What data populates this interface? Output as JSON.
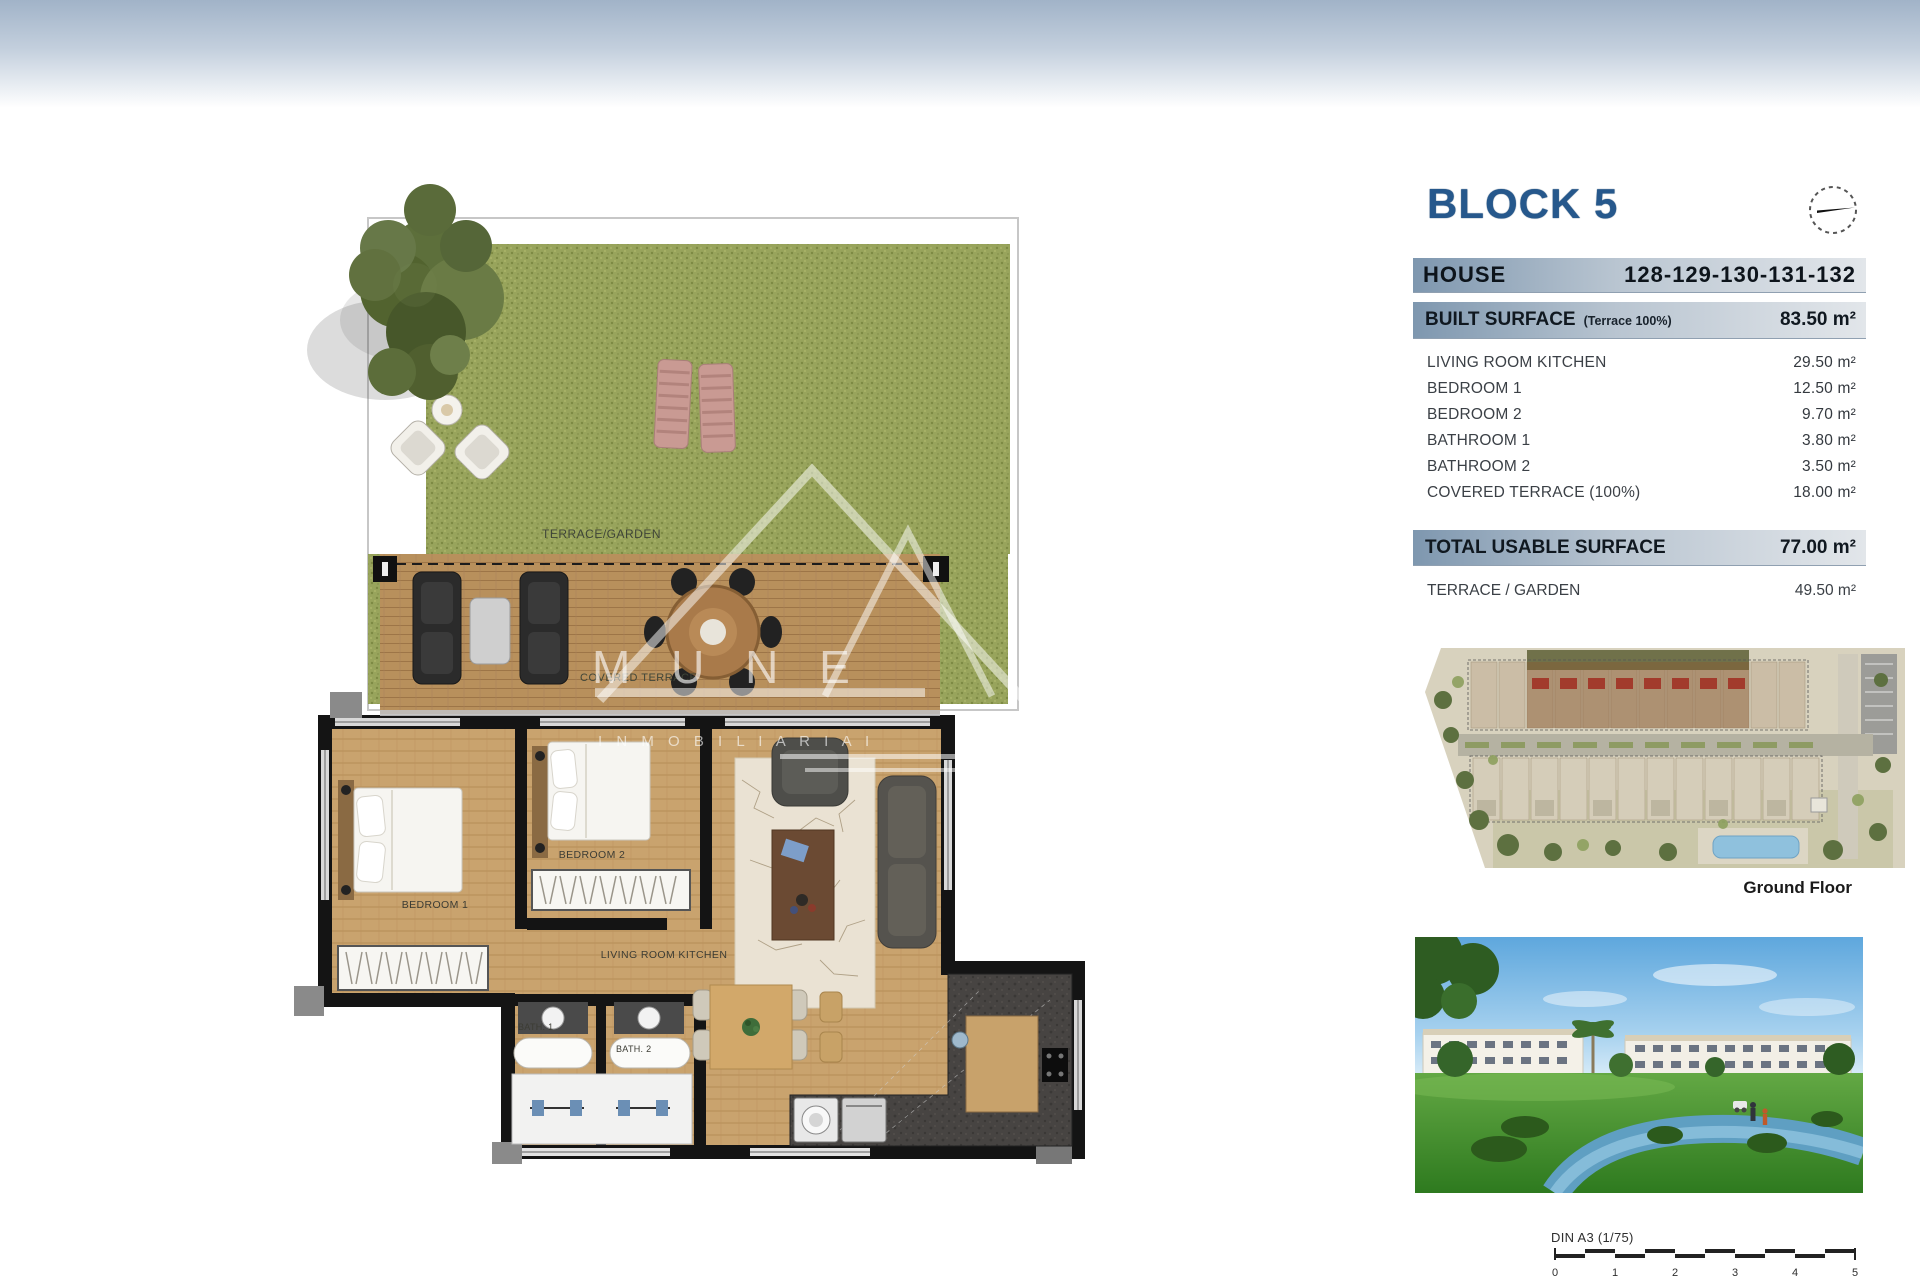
{
  "header": {
    "title": "BLOCK 5"
  },
  "house": {
    "label": "HOUSE",
    "numbers": "128-129-130-131-132"
  },
  "surface_table": {
    "built": {
      "label": "BUILT SURFACE",
      "note": "(Terrace 100%)",
      "value": "83.50 m²"
    },
    "rows": [
      {
        "label": "LIVING ROOM KITCHEN",
        "value": "29.50 m²"
      },
      {
        "label": "BEDROOM 1",
        "value": "12.50 m²"
      },
      {
        "label": "BEDROOM 2",
        "value": "9.70 m²"
      },
      {
        "label": "BATHROOM 1",
        "value": "3.80 m²"
      },
      {
        "label": "BATHROOM 2",
        "value": "3.50 m²"
      },
      {
        "label": "COVERED TERRACE (100%)",
        "value": "18.00 m²"
      }
    ],
    "total": {
      "label": "TOTAL USABLE SURFACE",
      "value": "77.00 m²"
    },
    "extra": {
      "label": "TERRACE / GARDEN",
      "value": "49.50 m²"
    }
  },
  "site_plan": {
    "caption": "Ground Floor"
  },
  "floor_plan": {
    "labels": {
      "terrace_garden": "TERRACE/GARDEN",
      "covered_terrace": "COVERED TERRACE",
      "bedroom1": "BEDROOM 1",
      "bedroom2": "BEDROOM 2",
      "living": "LIVING ROOM KITCHEN",
      "bath1": "BATH. 1",
      "bath2": "BATH. 2"
    }
  },
  "watermark": {
    "line1": "M U N E",
    "line2": "I N M O B I L I A R I A   I"
  },
  "scale_bar": {
    "label": "DIN A3 (1/75)",
    "ticks": [
      "0",
      "1",
      "2",
      "3",
      "4",
      "5"
    ]
  },
  "colors": {
    "accent_blue": "#26588c",
    "bar_start": "#7e97af",
    "bar_end": "#e2e6ea",
    "grass": "#98a45c",
    "deck_wood": "#b8905c",
    "floor_wood": "#c9a36e"
  }
}
